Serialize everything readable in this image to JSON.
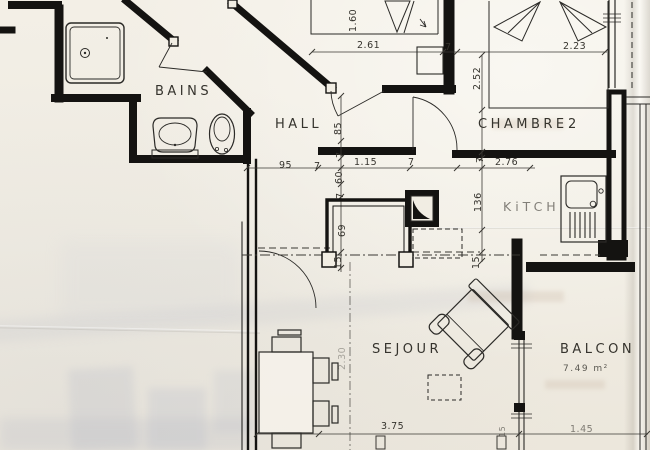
{
  "rooms": {
    "bains": "BAINS",
    "hall": "HALL",
    "chambre2": "CHAMBRE",
    "chambre2_num": "2",
    "kitch": "KiTCH",
    "sejour": "SEJOUR",
    "balcon": "BALCON",
    "balcon_area": "7.49 m²"
  },
  "dims": {
    "v160": "1.60",
    "d261": "2.61",
    "d7_top": "7",
    "d223": "2.23",
    "v252": "2.52",
    "v85": "85",
    "d95": "95",
    "d7_hall": "7",
    "v7_a": "7",
    "v60": "60",
    "v7_b": "7",
    "d115": "1.15",
    "d7_c": "7",
    "v7_d": "7",
    "d276": "2.76",
    "v136": "136",
    "v69": "69",
    "v15_a": "15",
    "v15_b": "15",
    "v230": "2.30",
    "d375": "3.75",
    "v15_c": "15",
    "d145": "1.45"
  },
  "colors": {
    "ink": "#141311",
    "thin": "#2b2a27",
    "paper": "#f1ede3"
  }
}
